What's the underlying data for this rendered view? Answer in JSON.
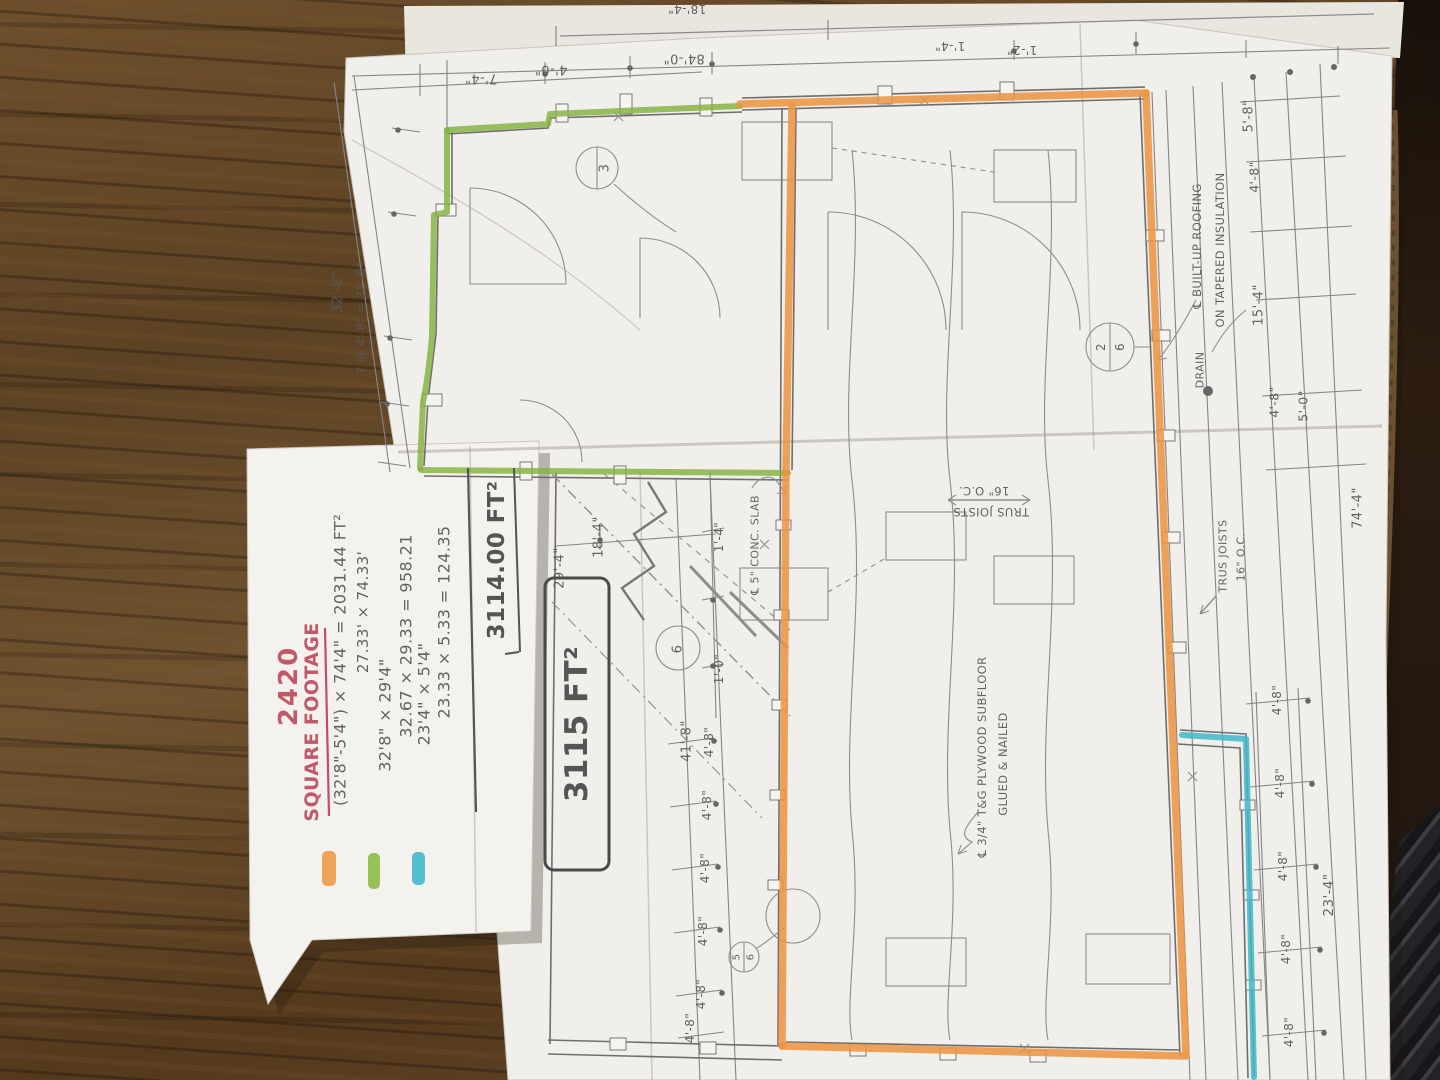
{
  "colors": {
    "red_ink": "#c14f62",
    "highlight_orange": "#ec9440",
    "highlight_green": "#84b23e",
    "highlight_blue": "#41b7c9",
    "pencil": "#5a5a5a"
  },
  "notes": {
    "number": "2420",
    "title": "SQUARE FOOTAGE",
    "calc1a": "(32'8\"-5'4\") × 74'4\" = 2031.44 FT²",
    "calc1b": "27.33' × 74.33'",
    "calc2a": "32'8\" × 29'4\"",
    "calc2b": "32.67 × 29.33 = 958.21",
    "calc3a": "23'4\" × 5'4\"",
    "calc3b": "23.33 × 5.33 = 124.35",
    "total": "3114.00 FT²",
    "total_rounded": "3115 FT²",
    "swatches": {
      "orange": "#ee9742",
      "green": "#8ab840",
      "blue": "#3fb6c9"
    }
  },
  "plan": {
    "dims": {
      "d7_4": "7'-4\"",
      "d4_0": "4'-0\"",
      "d84_0": "84'-0\"",
      "d1_2": "1'-2\"",
      "d1_4": "1'-4\"",
      "d18_4": "18'-4\"",
      "d32_8": "32'-8\"",
      "d7at": "7 @ 4'-8\" = 32'-8\"",
      "d4_8": "4'-8\"",
      "d5_8": "5'-8\"",
      "d15_4": "15'-4\"",
      "d5_0": "5'-0\"",
      "d74_4": "74'-4\"",
      "d29_4": "29'-4\"",
      "d1_0": "1'-0\"",
      "d41_8": "41'-8\"",
      "d23_4": "23'-4\""
    },
    "annotations": {
      "truss": "TRUS JOISTS",
      "oc": "16\" O.C.",
      "builtup1": "℄ BUILT-UP ROOFING",
      "builtup2": "ON TAPERED INSULATION",
      "drain": "DRAIN",
      "plywood1": "℄ 3/4\" T&G PLYWOOD SUBFLOOR",
      "plywood2": "GLUED & NAILED",
      "slab": "℄ 5\" CONC. SLAB"
    },
    "tags": {
      "t1": "3",
      "t2a": "2",
      "t2b": "6",
      "t3": "6",
      "t4a": "5",
      "t4b": "6"
    }
  }
}
